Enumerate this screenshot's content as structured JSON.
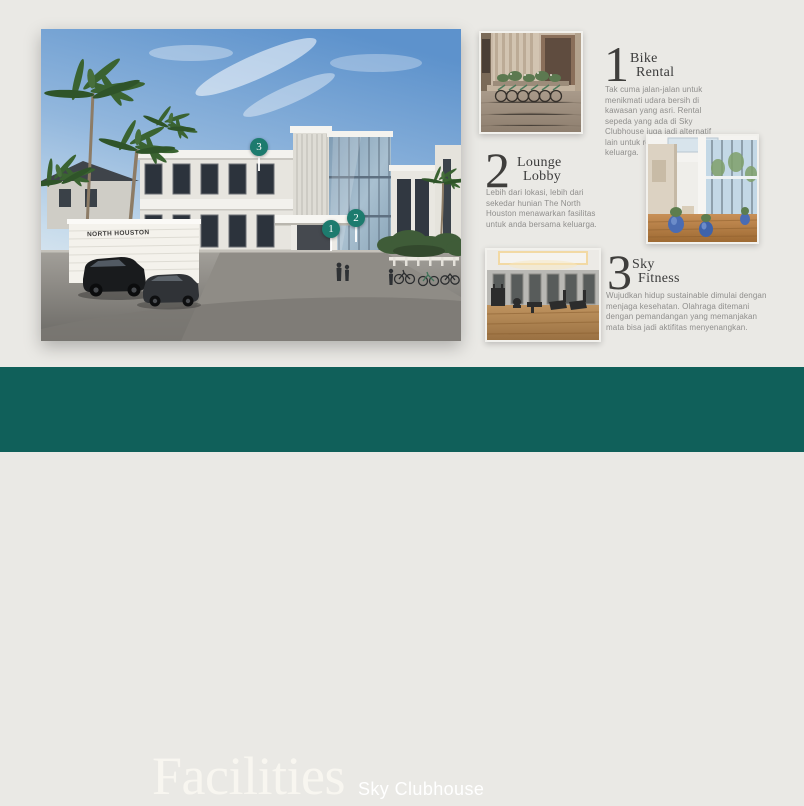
{
  "banner": {
    "title": "Facilities",
    "subtitle": "Sky Clubhouse",
    "bg_color": "#10605a"
  },
  "main_image": {
    "sign_text": "NORTH HOUSTON",
    "markers": [
      {
        "number": "1"
      },
      {
        "number": "2"
      },
      {
        "number": "3"
      }
    ]
  },
  "facilities": [
    {
      "number": "1",
      "title_line1": "Bike",
      "title_line2": "Rental",
      "description": "Tak cuma jalan-jalan untuk menikmati udara bersih di kawasan yang asri. Rental sepeda yang ada di Sky Clubhouse juga jadi alternatif lain untuk refreshing bersama keluarga."
    },
    {
      "number": "2",
      "title_line1": "Lounge",
      "title_line2": "Lobby",
      "description": "Lebih dari lokasi, lebih dari sekedar hunian The North Houston menawarkan fasilitas untuk anda bersama keluarga."
    },
    {
      "number": "3",
      "title_line1": "Sky",
      "title_line2": "Fitness",
      "description": "Wujudkan hidup sustainable dimulai dengan menjaga kesehatan. Olahraga ditemani dengan pemandangan yang memanjakan mata bisa jadi aktifitas menyenangkan."
    }
  ],
  "colors": {
    "accent_teal": "#1d7b6e",
    "banner_teal": "#10605a",
    "text_dark": "#3b3b3b",
    "text_gray": "#8f8e8c",
    "background": "#eae9e5"
  }
}
